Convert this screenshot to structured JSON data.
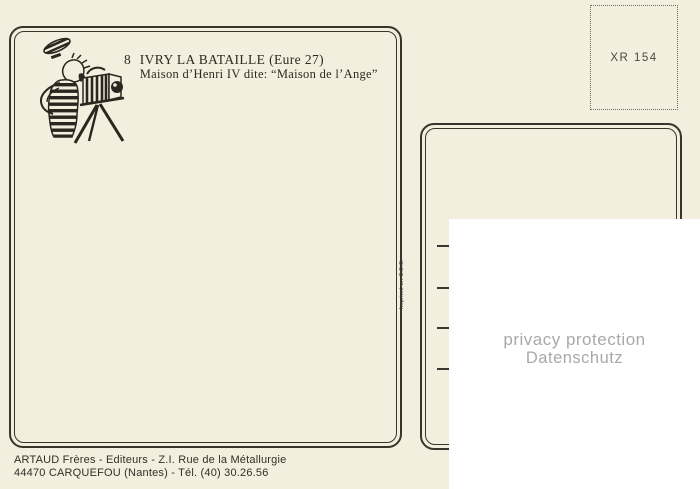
{
  "card": {
    "number": "8",
    "title_line1": "IVRY LA BATAILLE (Eure 27)",
    "title_line2": "Maison d’Henri IV dite: “Maison de l’Ange”"
  },
  "stamp_box": {
    "code": "XR 154"
  },
  "imprint": {
    "vertical_text": "Imprimé en C.E.E."
  },
  "publisher": {
    "line1": "ARTAUD Frères - Editeurs - Z.I. Rue de la Métallurgie",
    "line2": "44470 CARQUEFOU (Nantes) - Tél. (40) 30.26.56"
  },
  "privacy_overlay": {
    "line1": "privacy protection",
    "line2": "Datenschutz"
  },
  "illustration": {
    "name": "photographer-with-bellows-camera"
  },
  "address_area": {
    "lines_count": 4
  },
  "colors": {
    "background": "#f3efde",
    "ink": "#39342b",
    "stamp_code_text": "#4d4842",
    "privacy_text": "#a9a9a9",
    "overlay_background": "#ffffff"
  }
}
